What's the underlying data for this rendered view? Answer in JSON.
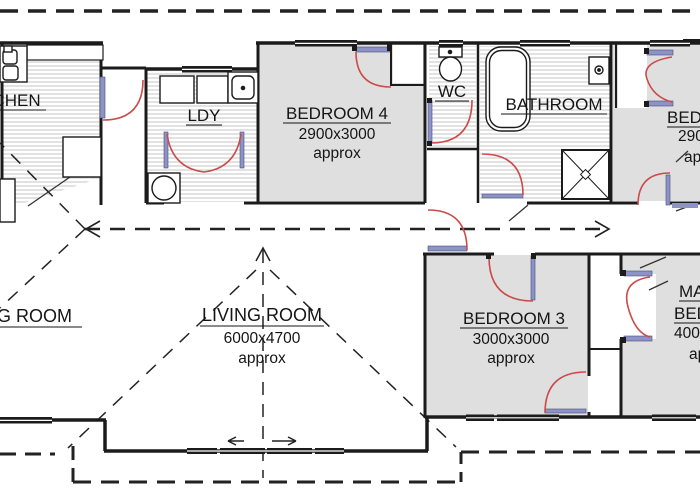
{
  "plan_title": "floor plan",
  "rooms": {
    "kitchen": {
      "label": "KITCHEN"
    },
    "laundry": {
      "label": "LDY"
    },
    "bedroom4": {
      "label": "BEDROOM 4",
      "dims": "2900x3000",
      "approx": "approx"
    },
    "wc": {
      "label": "WC"
    },
    "bathroom": {
      "label": "BATHROOM"
    },
    "bedroom2": {
      "label": "BEDROOM 2",
      "dims": "2900x3000",
      "approx": "approx"
    },
    "dining": {
      "label": "DINING ROOM"
    },
    "living": {
      "label": "LIVING ROOM",
      "dims": "6000x4700",
      "approx": "approx"
    },
    "bedroom3": {
      "label": "BEDROOM 3",
      "dims": "3000x3000",
      "approx": "approx"
    },
    "master": {
      "line1": "MASTER",
      "line2": "BEDROOM",
      "dims": "4000x3000",
      "approx": "approx"
    }
  },
  "colors": {
    "wall": "#1b1b1b",
    "room_fill": "#dfdfdf",
    "hatch_line": "#c6c6c6",
    "door_swing_red": "#cc4a4a",
    "door_leaf_blue": "#8d92c7",
    "background": "#ffffff"
  }
}
